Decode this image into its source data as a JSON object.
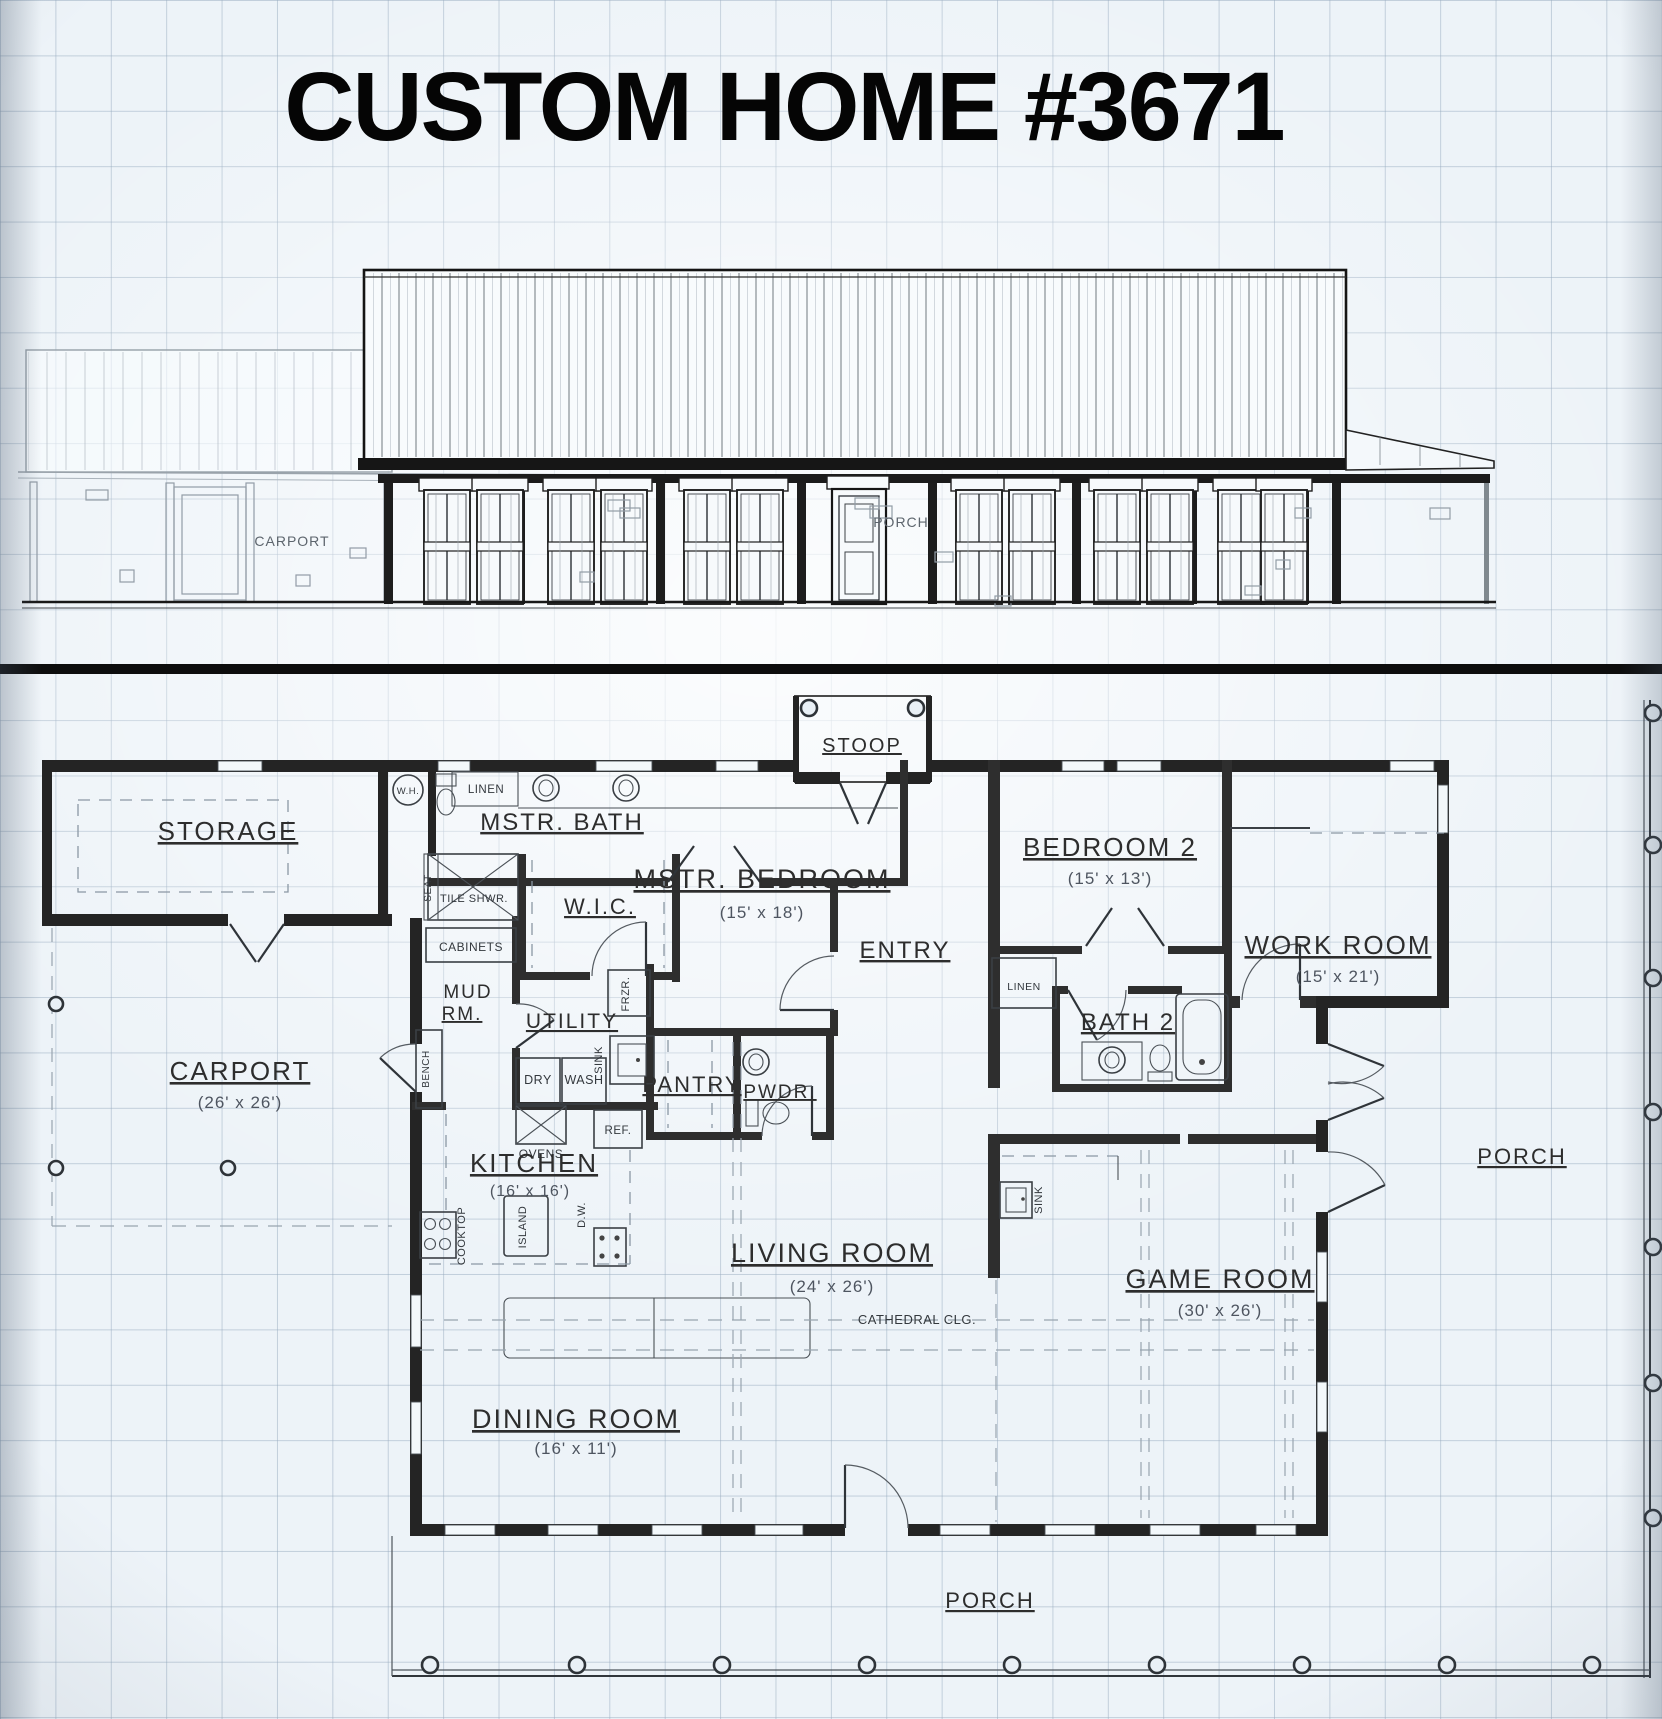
{
  "title": "CUSTOM HOME #3671",
  "elevation": {
    "carport_label": "CARPORT",
    "porch_label": "PORCH"
  },
  "plan": {
    "stoop": "STOOP",
    "storage": "STORAGE",
    "carport": {
      "name": "CARPORT",
      "dims": "(26' x 26')"
    },
    "wh": "W.H.",
    "linen_bath": "LINEN",
    "mstr_bath": "MSTR. BATH",
    "seat": "SEAT",
    "tile_shwr": "TILE SHWR.",
    "wic": "W.I.C.",
    "cabinets": "CABINETS",
    "mud_rm_line1": "MUD",
    "mud_rm_line2": "RM.",
    "bench": "BENCH",
    "utility": "UTILITY",
    "frzr": "FRZR.",
    "sink_utility": "SINK",
    "dry": "DRY",
    "wash": "WASH",
    "ovens": "OVENS",
    "ref": "REF.",
    "kitchen": {
      "name": "KITCHEN",
      "dims": "(16' x 16')"
    },
    "island": "ISLAND",
    "dw": "D.W.",
    "cooktop": "COOKTOP",
    "pantry": "PANTRY",
    "pwdr": "PWDR.",
    "mstr_bedroom": {
      "name": "MSTR. BEDROOM",
      "dims": "(15' x 18')"
    },
    "entry": "ENTRY",
    "bedroom2": {
      "name": "BEDROOM 2",
      "dims": "(15' x 13')"
    },
    "linen_hall": "LINEN",
    "bath2": "BATH 2",
    "work_room": {
      "name": "WORK ROOM",
      "dims": "(15' x 21')"
    },
    "living_room": {
      "name": "LIVING ROOM",
      "dims": "(24' x 26')"
    },
    "cathedral": "CATHEDRAL CLG.",
    "sink_bar": "SINK",
    "game_room": {
      "name": "GAME ROOM",
      "dims": "(30' x 26')"
    },
    "dining_room": {
      "name": "DINING ROOM",
      "dims": "(16' x 11')"
    },
    "porch_right": "PORCH",
    "porch_bottom": "PORCH"
  }
}
